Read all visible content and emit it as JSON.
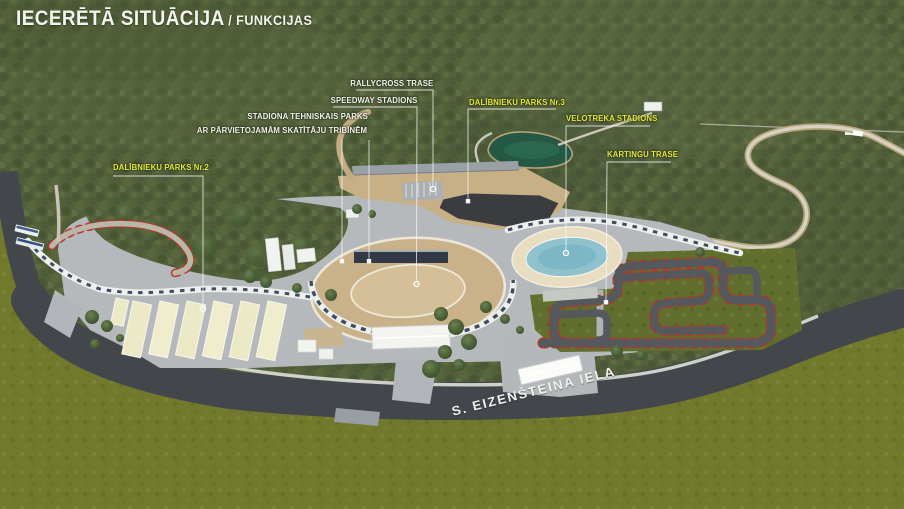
{
  "title": {
    "main": "IECERĒTĀ SITUĀCIJA",
    "sub": "/ FUNKCIJAS"
  },
  "annotations": [
    {
      "id": "rallycross-trase",
      "label": "RALLYCROSS TRASE",
      "color": "#f2f2ec"
    },
    {
      "id": "speedway-stadions",
      "label": "SPEEDWAY STADIONS",
      "color": "#f2f2ec"
    },
    {
      "id": "stadiona-tehniskais-parks",
      "label": "STADIONA TEHNISKAIS PARKS",
      "color": "#f2f2ec"
    },
    {
      "id": "parvietojamas-tribines",
      "label": "AR PĀRVIETOJAMĀM SKATĪTĀJU TRIBĪNĒM",
      "color": "#f2f2ec"
    },
    {
      "id": "dalibnieku-parks-nr3",
      "label": "DALĪBNIEKU PARKS Nr.3",
      "color": "#e4e838"
    },
    {
      "id": "velotreka-stadions",
      "label": "VELOTREKA STADIONS",
      "color": "#e4e838"
    },
    {
      "id": "kartingu-trase",
      "label": "KARTINGU TRASE",
      "color": "#e4e838"
    },
    {
      "id": "dalibnieku-parks-nr2",
      "label": "DALĪBNIEKU PARKS Nr.2",
      "color": "#e4e838"
    }
  ],
  "street_label": "S. EIZENŠTEINA IELA",
  "colors": {
    "forest": "#53603a",
    "field": "#71792c",
    "road": "#43474b",
    "plaza": "#b6b9bc",
    "pond": "#245846",
    "speedway_tan": "#c9b289",
    "velodrome_blue": "#8fc2cd",
    "karting_asphalt": "#55585c",
    "curb_red": "#a93b30",
    "asphalt_lot": "#3a3c3f",
    "tent_cream": "#ece9c6",
    "label_white": "#f2f2ec",
    "label_yellow": "#e4e838"
  }
}
